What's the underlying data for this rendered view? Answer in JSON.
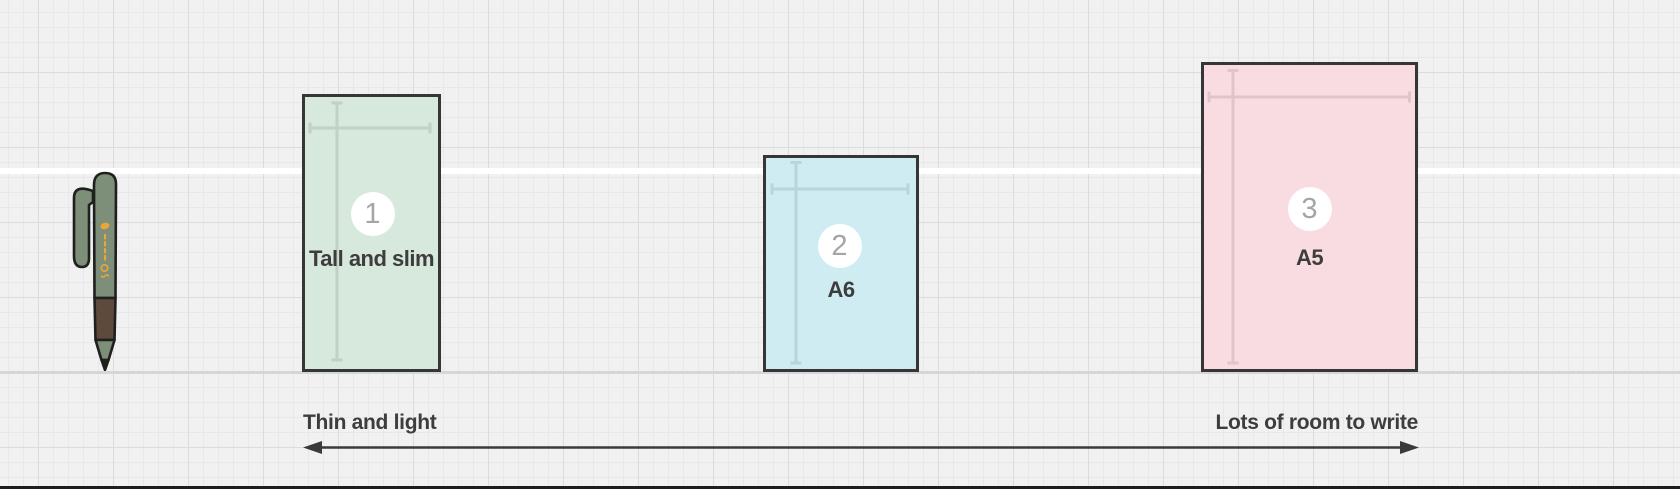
{
  "canvas": {
    "background_color": "#f1f1f2",
    "grid_minor_color": "#e8e8eb",
    "grid_major_color": "#dcdcdf",
    "baseline_band_color": "#ffffff",
    "floor_line_color": "#d6d6d9",
    "bottom_bar_color": "#1d1d1d",
    "dimension_line_color": "rgba(0,0,0,0.10)"
  },
  "pen": {
    "body_color": "#7d8f78",
    "grip_color": "#5d4a3d",
    "outline_color": "#1f1f1d",
    "logo_color": "#e9a63a"
  },
  "notebooks": [
    {
      "number": "1",
      "label": "Tall and slim",
      "fill_color": "#d7e9dc",
      "border_color": "#363636"
    },
    {
      "number": "2",
      "label": "A6",
      "fill_color": "#cfecf3",
      "border_color": "#363636"
    },
    {
      "number": "3",
      "label": "A5",
      "fill_color": "#f9dce2",
      "border_color": "#363636"
    }
  ],
  "badge": {
    "background_color": "#ffffff",
    "number_color": "#a5a5a5"
  },
  "axis": {
    "left_label": "Thin and light",
    "right_label": "Lots of room to write",
    "color": "#3a3a3a"
  },
  "label_text_color": "#3d3d3d"
}
